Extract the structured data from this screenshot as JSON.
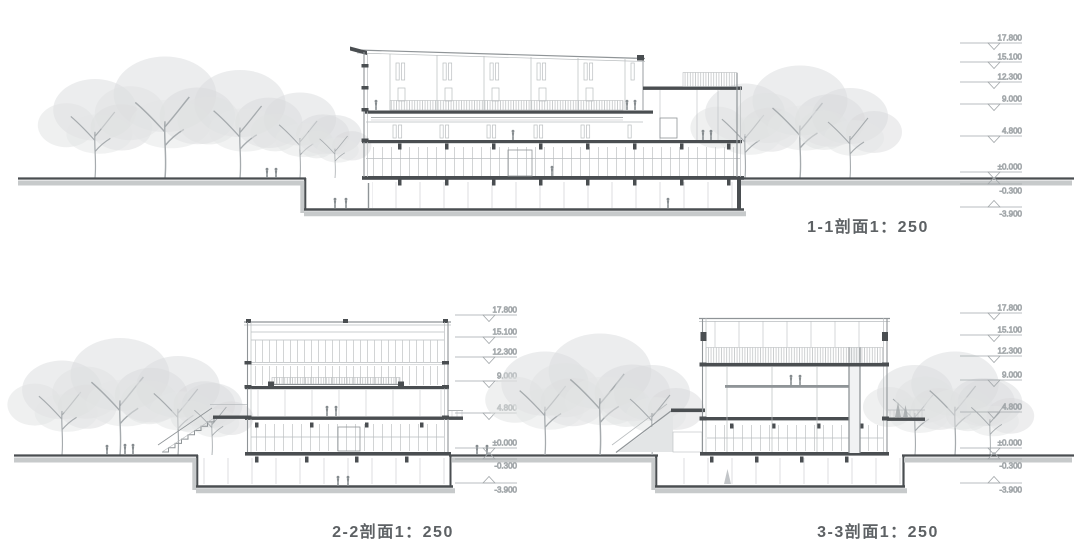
{
  "colors": {
    "background": "#ffffff",
    "cut_line_dark": "#4a4e51",
    "line_medium": "#8f9497",
    "line_light": "#b9bdbf",
    "ground_band": "#c7cacb",
    "tree_fill": "#dadcdd",
    "marker_text": "#9aa0a3",
    "label_text": "#5d6164"
  },
  "sections": [
    {
      "id": "1-1",
      "label": "1-1剖面1：250"
    },
    {
      "id": "2-2",
      "label": "2-2剖面1：250"
    },
    {
      "id": "3-3",
      "label": "3-3剖面1：250"
    }
  ],
  "elevations": {
    "values": [
      "17.800",
      "15.100",
      "12.300",
      "9.000",
      "4.800",
      "±0.000",
      "-0.300",
      "-3.900"
    ]
  }
}
